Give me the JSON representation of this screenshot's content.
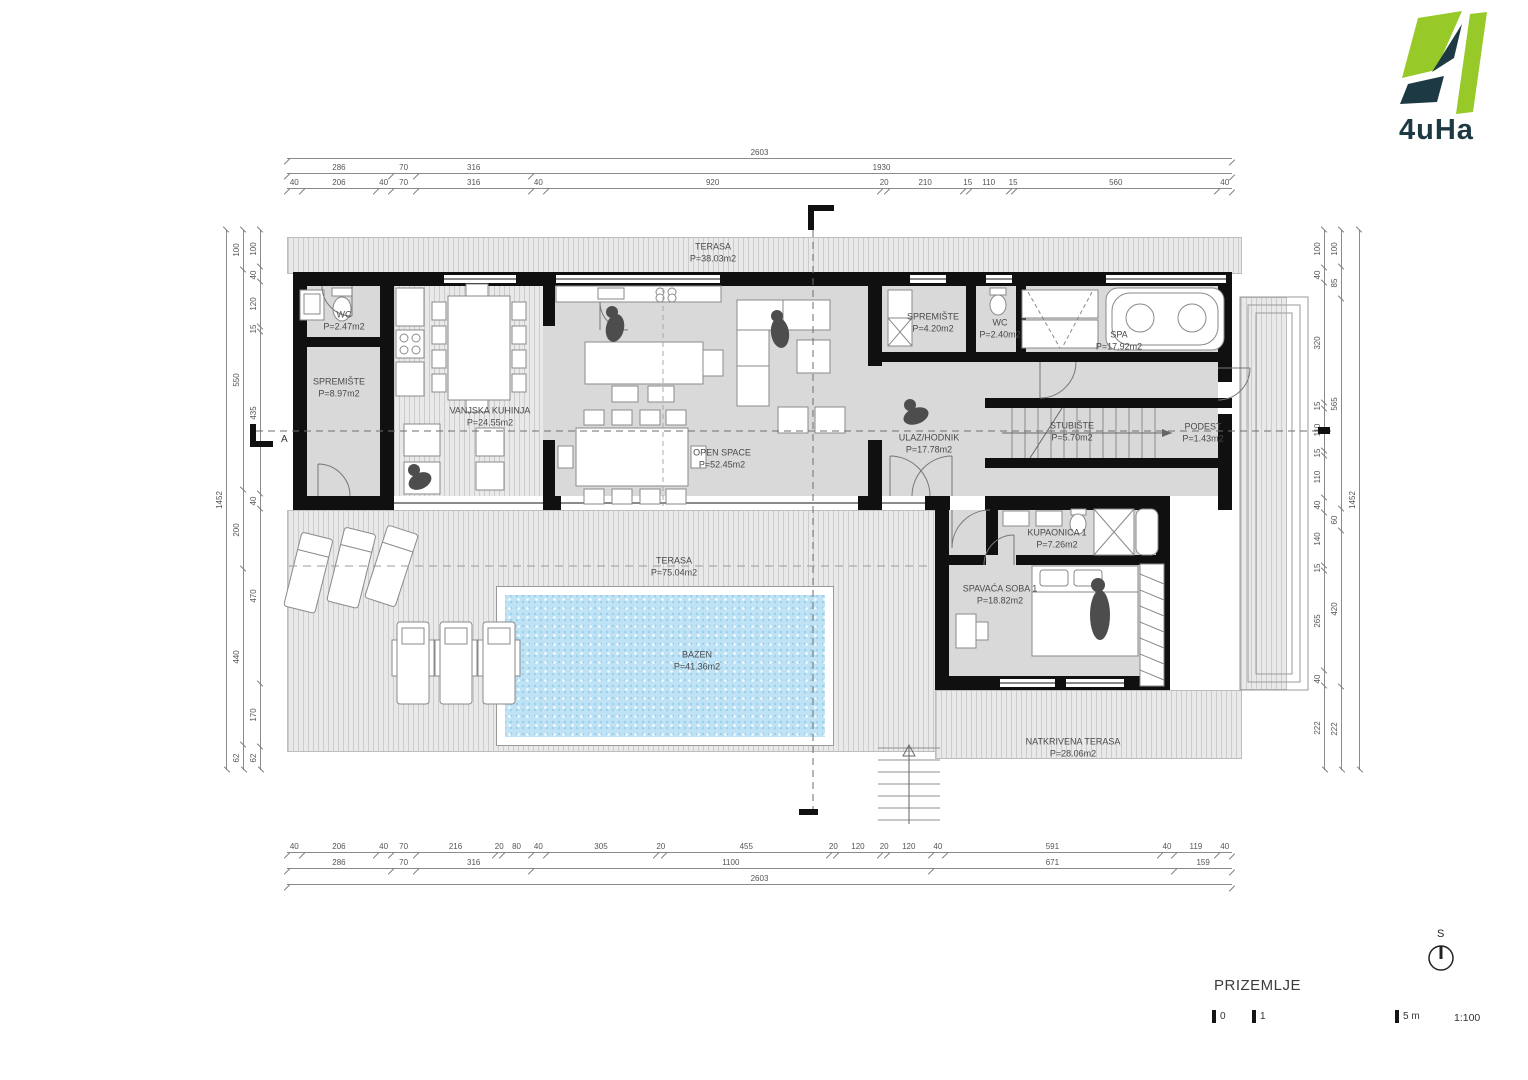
{
  "logo": {
    "brand": "4uHa"
  },
  "plan": {
    "title": "PRIZEMLJE",
    "scale_ratio": "1:100",
    "scale_ticks": [
      "0",
      "1",
      "5 m"
    ],
    "north_label": "S",
    "section_label_a": "A"
  },
  "rooms": {
    "terasa_top": {
      "name": "TERASA",
      "area": "P=38.03m2"
    },
    "wc1": {
      "name": "WC",
      "area": "P=2.47m2"
    },
    "spremiste1": {
      "name": "SPREMIŠTE",
      "area": "P=8.97m2"
    },
    "vanjska_kuhinja": {
      "name": "VANJSKA KUHINJA",
      "area": "P=24.55m2"
    },
    "open_space": {
      "name": "OPEN SPACE",
      "area": "P=52.45m2"
    },
    "spremiste2": {
      "name": "SPREMIŠTE",
      "area": "P=4.20m2"
    },
    "wc2": {
      "name": "WC",
      "area": "P=2.40m2"
    },
    "spa": {
      "name": "SPA",
      "area": "P=17.92m2"
    },
    "ulaz_hodnik": {
      "name": "ULAZ/HODNIK",
      "area": "P=17.78m2"
    },
    "stubiste": {
      "name": "STUBIŠTE",
      "area": "P=5.70m2"
    },
    "podest": {
      "name": "PODEST",
      "area": "P=1.43m2"
    },
    "kupaonica": {
      "name": "KUPAONICA 1",
      "area": "P=7.26m2"
    },
    "spavaca_soba": {
      "name": "SPAVAĆA SOBA 1",
      "area": "P=18.82m2"
    },
    "terasa_bottom": {
      "name": "TERASA",
      "area": "P=75.04m2"
    },
    "bazen": {
      "name": "BAZEN",
      "area": "P=41.36m2"
    },
    "natkrivena_terasa": {
      "name": "NATKRIVENA TERASA",
      "area": "P=28.06m2"
    }
  },
  "dimensions": {
    "top": {
      "total": [
        2603
      ],
      "coarse": [
        286,
        70,
        316,
        1930
      ],
      "fine": [
        40,
        206,
        40,
        70,
        316,
        40,
        920,
        20,
        210,
        15,
        110,
        15,
        560,
        40
      ]
    },
    "bottom": {
      "fine": [
        40,
        206,
        40,
        70,
        216,
        20,
        80,
        40,
        305,
        20,
        455,
        20,
        120,
        20,
        120,
        40,
        591,
        40,
        119,
        40
      ],
      "coarse": [
        286,
        70,
        316,
        1100,
        671,
        159
      ],
      "total": [
        2603
      ]
    },
    "left": {
      "total": [
        1452
      ],
      "coarse": [
        100,
        550,
        200,
        440,
        62
      ],
      "fine": [
        100,
        40,
        120,
        15,
        435,
        40,
        470,
        170,
        62
      ]
    },
    "right": {
      "fine": [
        100,
        40,
        320,
        15,
        110,
        15,
        110,
        40,
        140,
        15,
        265,
        40,
        222
      ],
      "coarse": [
        100,
        85,
        565,
        60,
        420,
        222
      ],
      "total": [
        1452
      ]
    }
  },
  "colors": {
    "wall": "#101010",
    "floor": "#d9d9d9",
    "terrace": "#e9e9e9",
    "pool": "#bfe3f5",
    "logo_green": "#97ca28",
    "logo_dark": "#1d3a44"
  }
}
